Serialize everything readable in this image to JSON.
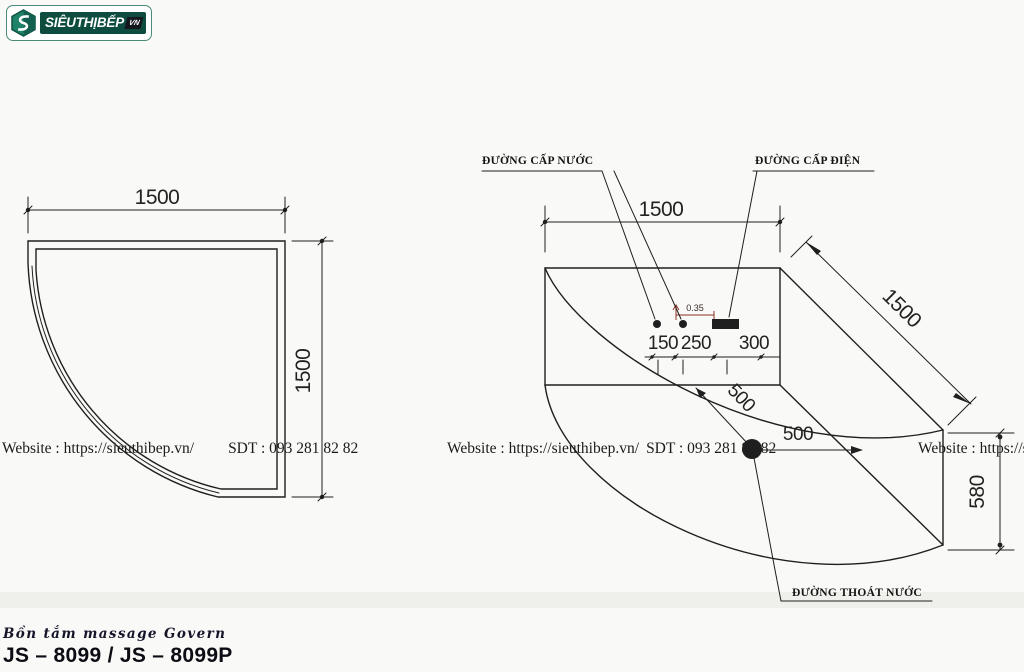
{
  "logo": {
    "brand": "SIÊUTHỊBẾP",
    "badge": "VN"
  },
  "watermark": {
    "website": "Website : https://sieuthibep.vn/",
    "phone": "SDT : 093 281 82 82"
  },
  "plan_view": {
    "width": "1500",
    "depth": "1500"
  },
  "axon_view": {
    "width": "1500",
    "side": "1500",
    "height": "580",
    "offset_150": "150",
    "offset_250": "250",
    "offset_300": "300",
    "drain_diag": "500",
    "drain_side": "500",
    "level": "0.35",
    "water_label": "ĐƯỜNG CẤP NƯỚC",
    "electric_label": "ĐƯỜNG CẤP ĐIỆN",
    "drain_label": "ĐƯỜNG THOÁT NƯỚC"
  },
  "footer": {
    "series": "Bồn tắm massage Govern",
    "model": "JS – 8099 / JS – 8099P"
  },
  "colors": {
    "line": "#1f1f1f",
    "brand_green": "#0d4c3f",
    "annotation_red": "#8a3324"
  }
}
